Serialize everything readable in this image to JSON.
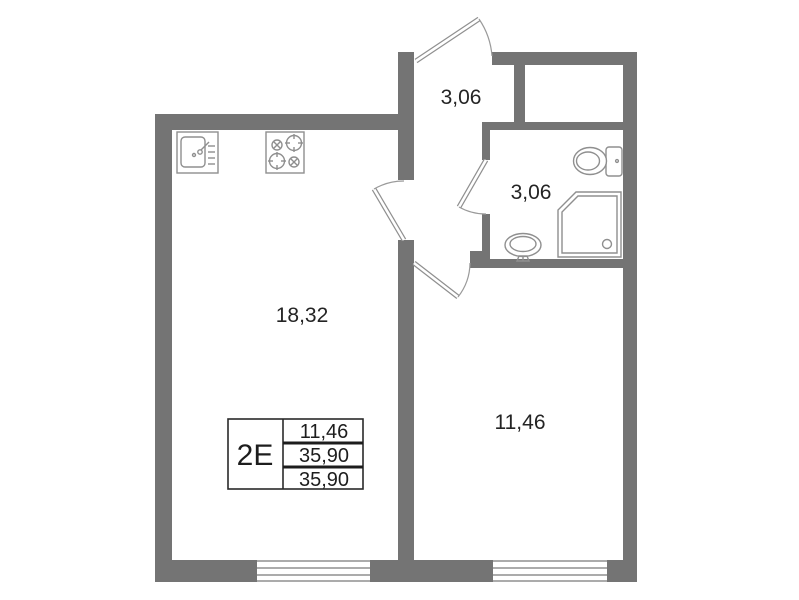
{
  "plan_title": "apartment-floor-plan",
  "stamp": {
    "type_label": "2Е",
    "values": {
      "row1": "11,46",
      "row2": "35,90",
      "row3": "35,90"
    }
  },
  "rooms": {
    "living_kitchen": {
      "area": "18,32"
    },
    "bedroom": {
      "area": "11,46"
    },
    "hallway": {
      "area": "3,06"
    },
    "bathroom": {
      "area": "3,06"
    }
  },
  "icons": {
    "kitchen-sink-icon": "square basin with faucet and drainer lines",
    "stove-icon": "four-burner cooktop",
    "toilet-icon": "bowl with cistern",
    "shower-icon": "corner shower tray with drain",
    "washbasin-icon": "oval basin on pedestal",
    "window-icon": "triple-line window symbol",
    "door-icon": "leaf with quarter-circle swing arc"
  },
  "colors": {
    "wall": "#747474",
    "fixture_stroke": "#8f8f8f",
    "label_text": "#242424",
    "stamp_border": "#2a2a2a",
    "background": "#ffffff"
  }
}
